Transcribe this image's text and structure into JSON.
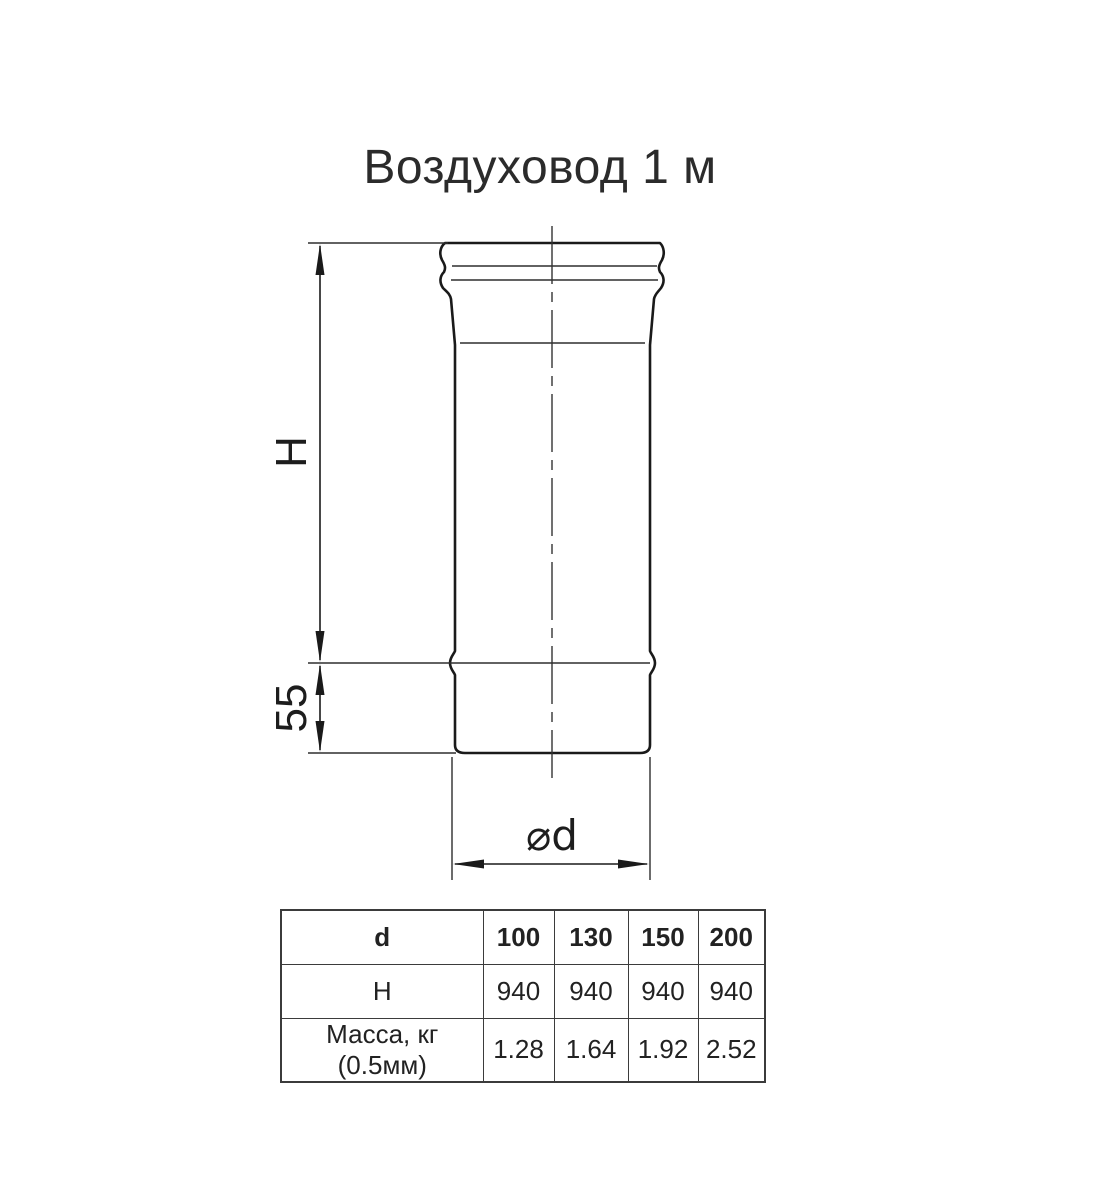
{
  "title": "Воздуховод 1 м",
  "drawing": {
    "height_label": "H",
    "collar_height_label": "55",
    "diameter_label": "⌀d"
  },
  "table": {
    "header": [
      "d",
      "100",
      "130",
      "150",
      "200"
    ],
    "rows": [
      [
        "H",
        "940",
        "940",
        "940",
        "940"
      ],
      [
        "Масса, кг (0.5мм)",
        "1.28",
        "1.64",
        "1.92",
        "2.52"
      ]
    ]
  },
  "colors": {
    "line": "#1a1a1a",
    "thin_line": "#2e2e2e",
    "text": "#222222",
    "table_border": "#3b3b3b",
    "background": "#ffffff"
  }
}
